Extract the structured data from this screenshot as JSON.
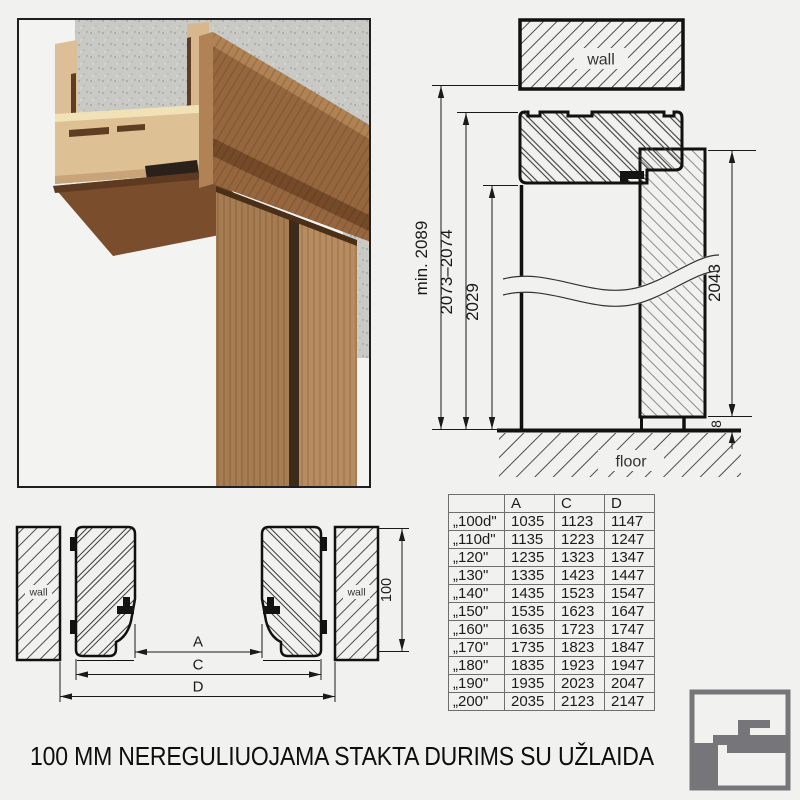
{
  "page": {
    "background": "#f1f1ef",
    "title": "100 MM NEREGULIUOJAMA STAKTA DURIMS SU UŽLAIDA"
  },
  "photo": {
    "description": "door-frame-corner-3d-render",
    "concrete_color": "#c9c9c5",
    "mdf_color": "#dcbf97",
    "wood_color": "#96673f",
    "seal_color": "#2b211a"
  },
  "vertical_section": {
    "wall_label": "wall",
    "floor_label": "floor",
    "dim_total": "min. 2089",
    "dim_frame": "2073–2074",
    "dim_opening": "2029",
    "dim_door": "2043",
    "dim_gap": "8"
  },
  "horizontal_section": {
    "wall_label": "wall",
    "dim_a": "A",
    "dim_c": "C",
    "dim_d": "D",
    "dim_depth": "100"
  },
  "table": {
    "headers": [
      "",
      "A",
      "C",
      "D"
    ],
    "rows": [
      [
        "„100d\"",
        "1035",
        "1123",
        "1147"
      ],
      [
        "„110d\"",
        "1135",
        "1223",
        "1247"
      ],
      [
        "„120\"",
        "1235",
        "1323",
        "1347"
      ],
      [
        "„130\"",
        "1335",
        "1423",
        "1447"
      ],
      [
        "„140\"",
        "1435",
        "1523",
        "1547"
      ],
      [
        "„150\"",
        "1535",
        "1623",
        "1647"
      ],
      [
        "„160\"",
        "1635",
        "1723",
        "1747"
      ],
      [
        "„170\"",
        "1735",
        "1823",
        "1847"
      ],
      [
        "„180\"",
        "1835",
        "1923",
        "1947"
      ],
      [
        "„190\"",
        "1935",
        "2023",
        "2047"
      ],
      [
        "„200\"",
        "2035",
        "2123",
        "2147"
      ]
    ]
  },
  "logo": {
    "color": "#76767a"
  }
}
